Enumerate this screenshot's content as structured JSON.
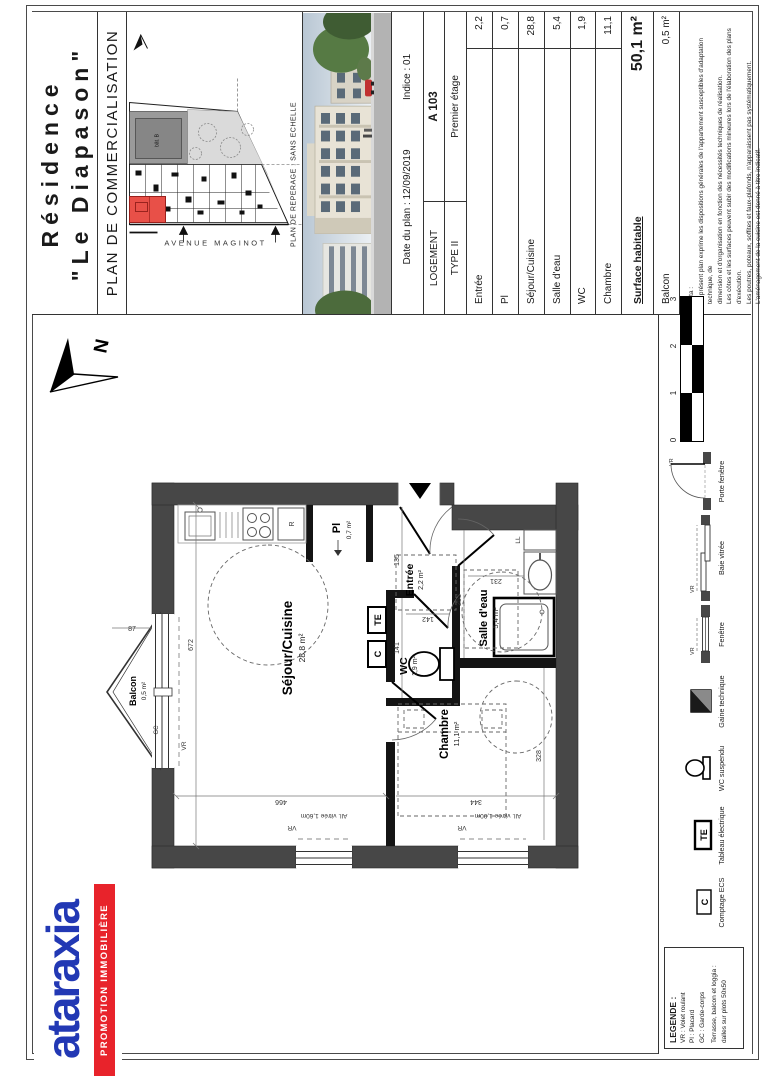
{
  "header": {
    "residence_line1": "Résidence",
    "residence_line2": "\"Le Diapason\"",
    "plan_title": "PLAN DE COMMERCIALISATION",
    "date": "Date du plan : 12/09/2019",
    "indice": "Indice : 01",
    "logement": "LOGEMENT",
    "unit": "A 103",
    "type": "TYPE II",
    "floor": "Premier étage",
    "rows": [
      {
        "label": "Entrée",
        "value": "2,2"
      },
      {
        "label": "Pl",
        "value": "0,7"
      },
      {
        "label": "Séjour/Cuisine",
        "value": "28,8"
      },
      {
        "label": "Salle d'eau",
        "value": "5,4"
      },
      {
        "label": "WC",
        "value": "1,9"
      },
      {
        "label": "Chambre",
        "value": "11,1"
      }
    ],
    "surface_label": "Surface habitable",
    "surface_value": "50,1 m²",
    "balcony_label": "Balcon",
    "balcony_value": "0,5 m²",
    "notes": [
      "Nota :",
      "Le présent plan exprime les dispositions générales de l'appartement susceptibles d'adaptation technique, de",
      "dimension et d'organisation en fonction des nécessités techniques de réalisation.",
      "Les côtes et les surfaces peuvent subir des modifications mineures lors de l'élaboration des plans d'exécution.",
      "Les poutres, poteaux, soffites et faux-plafonds, n'apparaissent pas systématiquement.",
      "L'aménagement de la cuisine est donné à titre indicatif."
    ]
  },
  "site_map": {
    "street": "AVENUE MAGINOT",
    "caption": "PLAN DE REPERAGE : SANS ECHELLE",
    "building": "bât. B"
  },
  "plan": {
    "rooms": {
      "sejour": {
        "name": "Séjour/Cuisine",
        "area": "28,8 m²"
      },
      "chambre": {
        "name": "Chambre",
        "area": "11,1 m²"
      },
      "salle_eau": {
        "name": "Salle d'eau",
        "area": "5,4 m²"
      },
      "wc": {
        "name": "WC",
        "area": "1,9 m²"
      },
      "entree": {
        "name": "Entrée",
        "area": "2,2 m²"
      },
      "placard": {
        "name": "Pl",
        "area": "0,7 m²"
      },
      "balcon": {
        "name": "Balcon",
        "area": "0,5 m²"
      }
    },
    "markers": {
      "vr": "VR",
      "gc": "GC",
      "te": "TE",
      "c": "C",
      "ll": "LL",
      "r": "R",
      "north": "N"
    },
    "dims": {
      "d672": "672",
      "d466": "466",
      "d344": "344",
      "d328": "328",
      "d87": "87",
      "d135": "135",
      "d141": "141",
      "d142": "142",
      "d253": "253",
      "d231": "231"
    },
    "alleges": {
      "a160": "All. vitrée 1,60m",
      "a100": "All. vitrée 1,00m"
    }
  },
  "legend_strip": {
    "items": [
      {
        "label": "Comptage ECS"
      },
      {
        "label": "Tableau électrique"
      },
      {
        "label": "WC suspendu"
      },
      {
        "label": "Gaine technique"
      },
      {
        "label": "Fenêtre"
      },
      {
        "label": "Baie vitrée"
      },
      {
        "label": "Porte fenêtre"
      }
    ],
    "scale": [
      "0",
      "1",
      "2",
      "3"
    ]
  },
  "legend_box": {
    "title": "LEGENDE :",
    "lines": [
      "VR : Volet roulant",
      "Pl : Placard",
      "GC : Garde-corps"
    ],
    "terrace": [
      "Terrasse, balcon et loggia :",
      "dalles sur plots 50x50"
    ]
  },
  "logo": {
    "name": "ataraxia",
    "tagline": "PROMOTION IMMOBILIÈRE"
  },
  "colors": {
    "logo_blue": "#2238b4",
    "logo_red": "#e8232b",
    "unit_red": "#e85048",
    "wall": "#474747"
  }
}
